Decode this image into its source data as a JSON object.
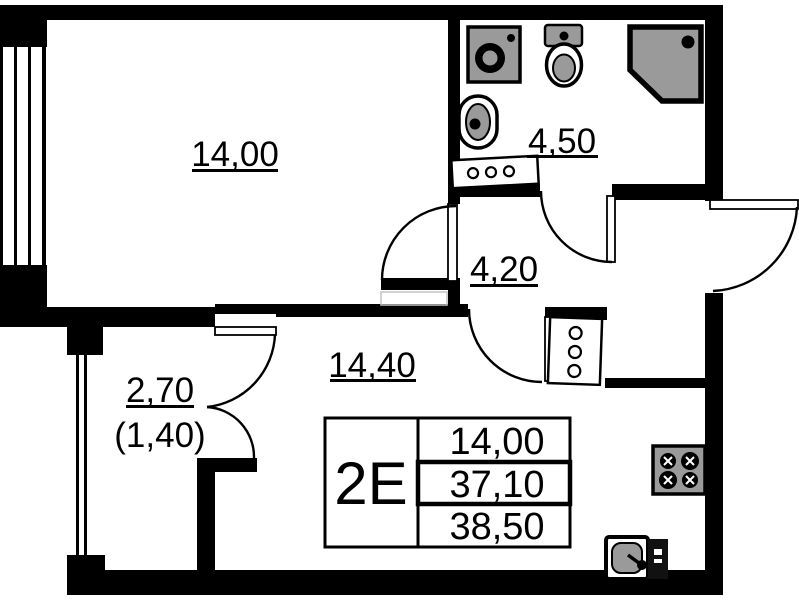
{
  "plan": {
    "unit_type": "2E",
    "rooms": {
      "bedroom": {
        "area": "14,00"
      },
      "bathroom": {
        "area": "4,50"
      },
      "hallway": {
        "area": "4,20"
      },
      "living": {
        "area": "14,40"
      },
      "balcony": {
        "area": "2,70",
        "area_reduced": "(1,40)"
      }
    },
    "legend": {
      "unit_type": "2E",
      "row1": "14,00",
      "row2": "37,10",
      "row3": "38,50"
    },
    "colors": {
      "walls": "#000000",
      "fixture_fill": "#9a9a9a",
      "background": "#ffffff"
    }
  }
}
